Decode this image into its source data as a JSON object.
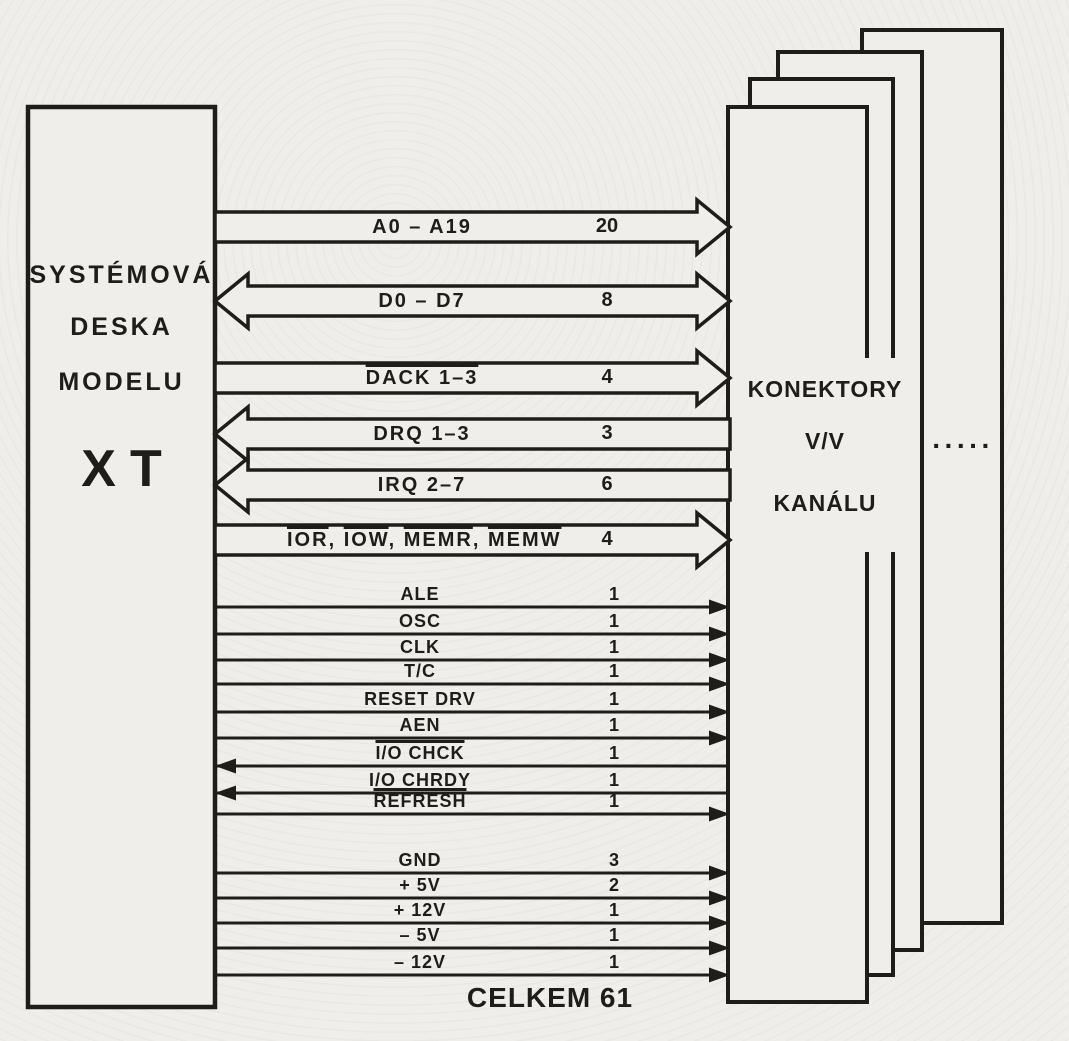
{
  "figure": {
    "paper_color": "#f0eeea",
    "ink_color": "#1f1d1a"
  },
  "left_box": {
    "title_lines": [
      "SYSTÉMOVÁ",
      "DESKA",
      "MODELU"
    ],
    "model": "XT"
  },
  "right_box": {
    "title_lines": [
      "KONEKTORY",
      "V/V",
      "KANÁLU"
    ],
    "ellipsis": "·····"
  },
  "buses": [
    {
      "label": "A0  –  A19",
      "count": "20",
      "direction": "right",
      "overline": false,
      "y": 227
    },
    {
      "label": "D0  –  D7",
      "count": "8",
      "direction": "both",
      "overline": false,
      "y": 301
    },
    {
      "label": "DACK 1–3",
      "count": "4",
      "direction": "right",
      "overline": true,
      "y": 378
    },
    {
      "label": "DRQ 1–3",
      "count": "3",
      "direction": "left",
      "overline": false,
      "y": 434
    },
    {
      "label": "IRQ 2–7",
      "count": "6",
      "direction": "left",
      "overline": false,
      "y": 485
    },
    {
      "parts": [
        "IOR",
        "IOW",
        "MEMR",
        "MEMW"
      ],
      "count": "4",
      "direction": "right",
      "y": 540
    }
  ],
  "signals": [
    {
      "label": "ALE",
      "count": "1",
      "direction": "right",
      "overline": false,
      "y": 607
    },
    {
      "label": "OSC",
      "count": "1",
      "direction": "right",
      "overline": false,
      "y": 634
    },
    {
      "label": "CLK",
      "count": "1",
      "direction": "right",
      "overline": false,
      "y": 660
    },
    {
      "label": "T/C",
      "count": "1",
      "direction": "right",
      "overline": false,
      "y": 684
    },
    {
      "label": "RESET DRV",
      "count": "1",
      "direction": "right",
      "overline": false,
      "y": 712
    },
    {
      "label": "AEN",
      "count": "1",
      "direction": "right",
      "overline": false,
      "y": 738
    },
    {
      "label": "I/O CHCK",
      "count": "1",
      "direction": "left",
      "overline": true,
      "y": 766
    },
    {
      "label": "I/O CHRDY",
      "count": "1",
      "direction": "left",
      "overline": false,
      "y": 793
    },
    {
      "label": "REFRESH",
      "count": "1",
      "direction": "right",
      "overline": true,
      "y": 814
    },
    {
      "label": "GND",
      "count": "3",
      "direction": "right",
      "overline": false,
      "y": 873
    },
    {
      "label": "+ 5V",
      "count": "2",
      "direction": "right",
      "overline": false,
      "y": 898
    },
    {
      "label": "+ 12V",
      "count": "1",
      "direction": "right",
      "overline": false,
      "y": 923
    },
    {
      "label": "– 5V",
      "count": "1",
      "direction": "right",
      "overline": false,
      "y": 948
    },
    {
      "label": "– 12V",
      "count": "1",
      "direction": "right",
      "overline": false,
      "y": 975
    }
  ],
  "footer": {
    "total": "CELKEM 61"
  }
}
